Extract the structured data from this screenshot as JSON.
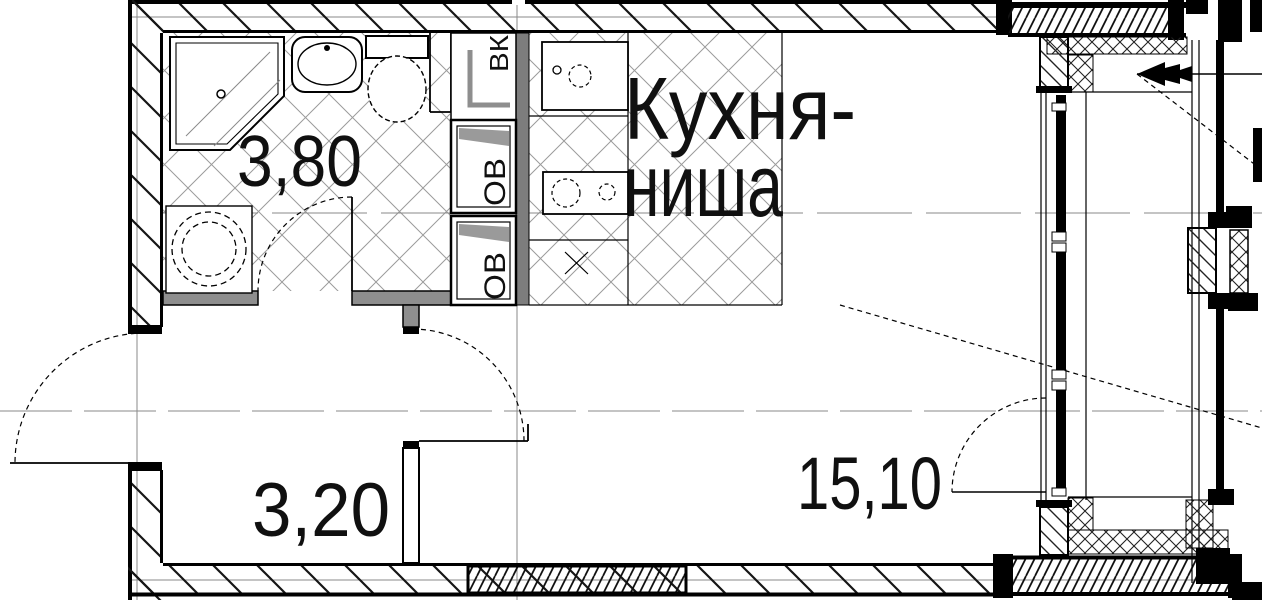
{
  "rooms": {
    "bathroom": {
      "area": "3,80"
    },
    "hallway": {
      "area": "3,20"
    },
    "living_room": {
      "area": "15,10"
    },
    "kitchen_niche": {
      "label_line1": "Кухня-",
      "label_line2": "ниша"
    }
  },
  "shafts": {
    "vk_label": "ВК",
    "ov_top_label": "ОВ",
    "ov_bottom_label": "ОВ"
  },
  "colors": {
    "background": "#ffffff",
    "line": "#000000",
    "partition_gray": "#8e8e8e",
    "shaft_strip_gray": "#7d7d7d",
    "axis_gray": "#8a8a8a",
    "tile_gray": "#9b9b9b"
  }
}
